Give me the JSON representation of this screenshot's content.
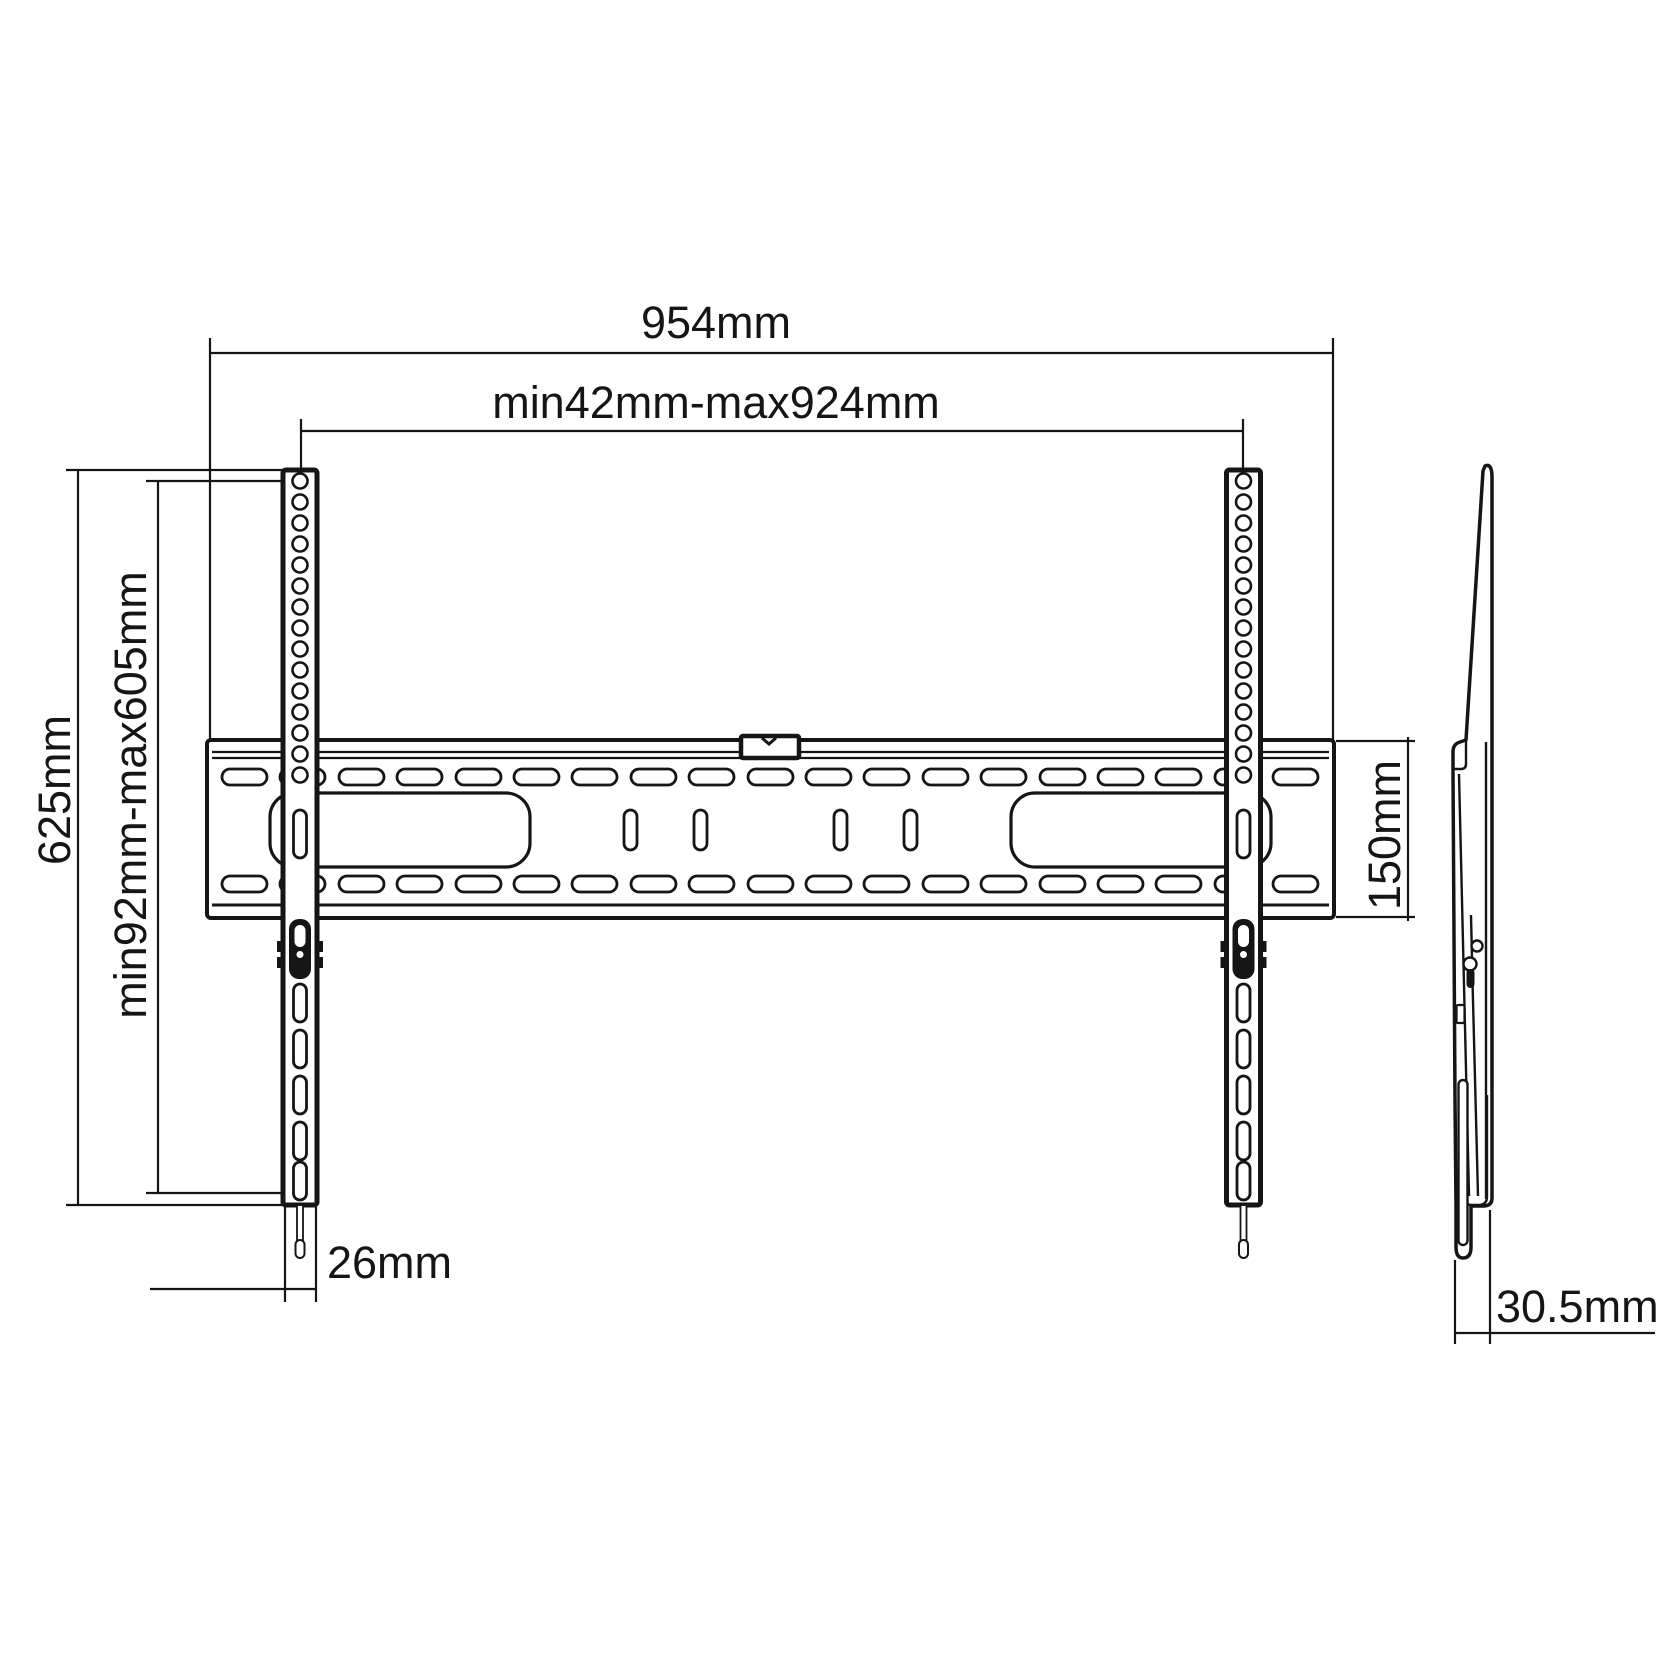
{
  "colors": {
    "background": "#ffffff",
    "line": "#151515"
  },
  "dimensions": {
    "overall_width": {
      "label": "954mm"
    },
    "horizontal_range": {
      "label": "min42mm-max924mm"
    },
    "overall_height": {
      "label": "625mm"
    },
    "vertical_range": {
      "label": "min92mm-max605mm"
    },
    "plate_height": {
      "label": "150mm"
    },
    "rail_width": {
      "label": "26mm"
    },
    "profile_depth": {
      "label": "30.5mm"
    }
  }
}
